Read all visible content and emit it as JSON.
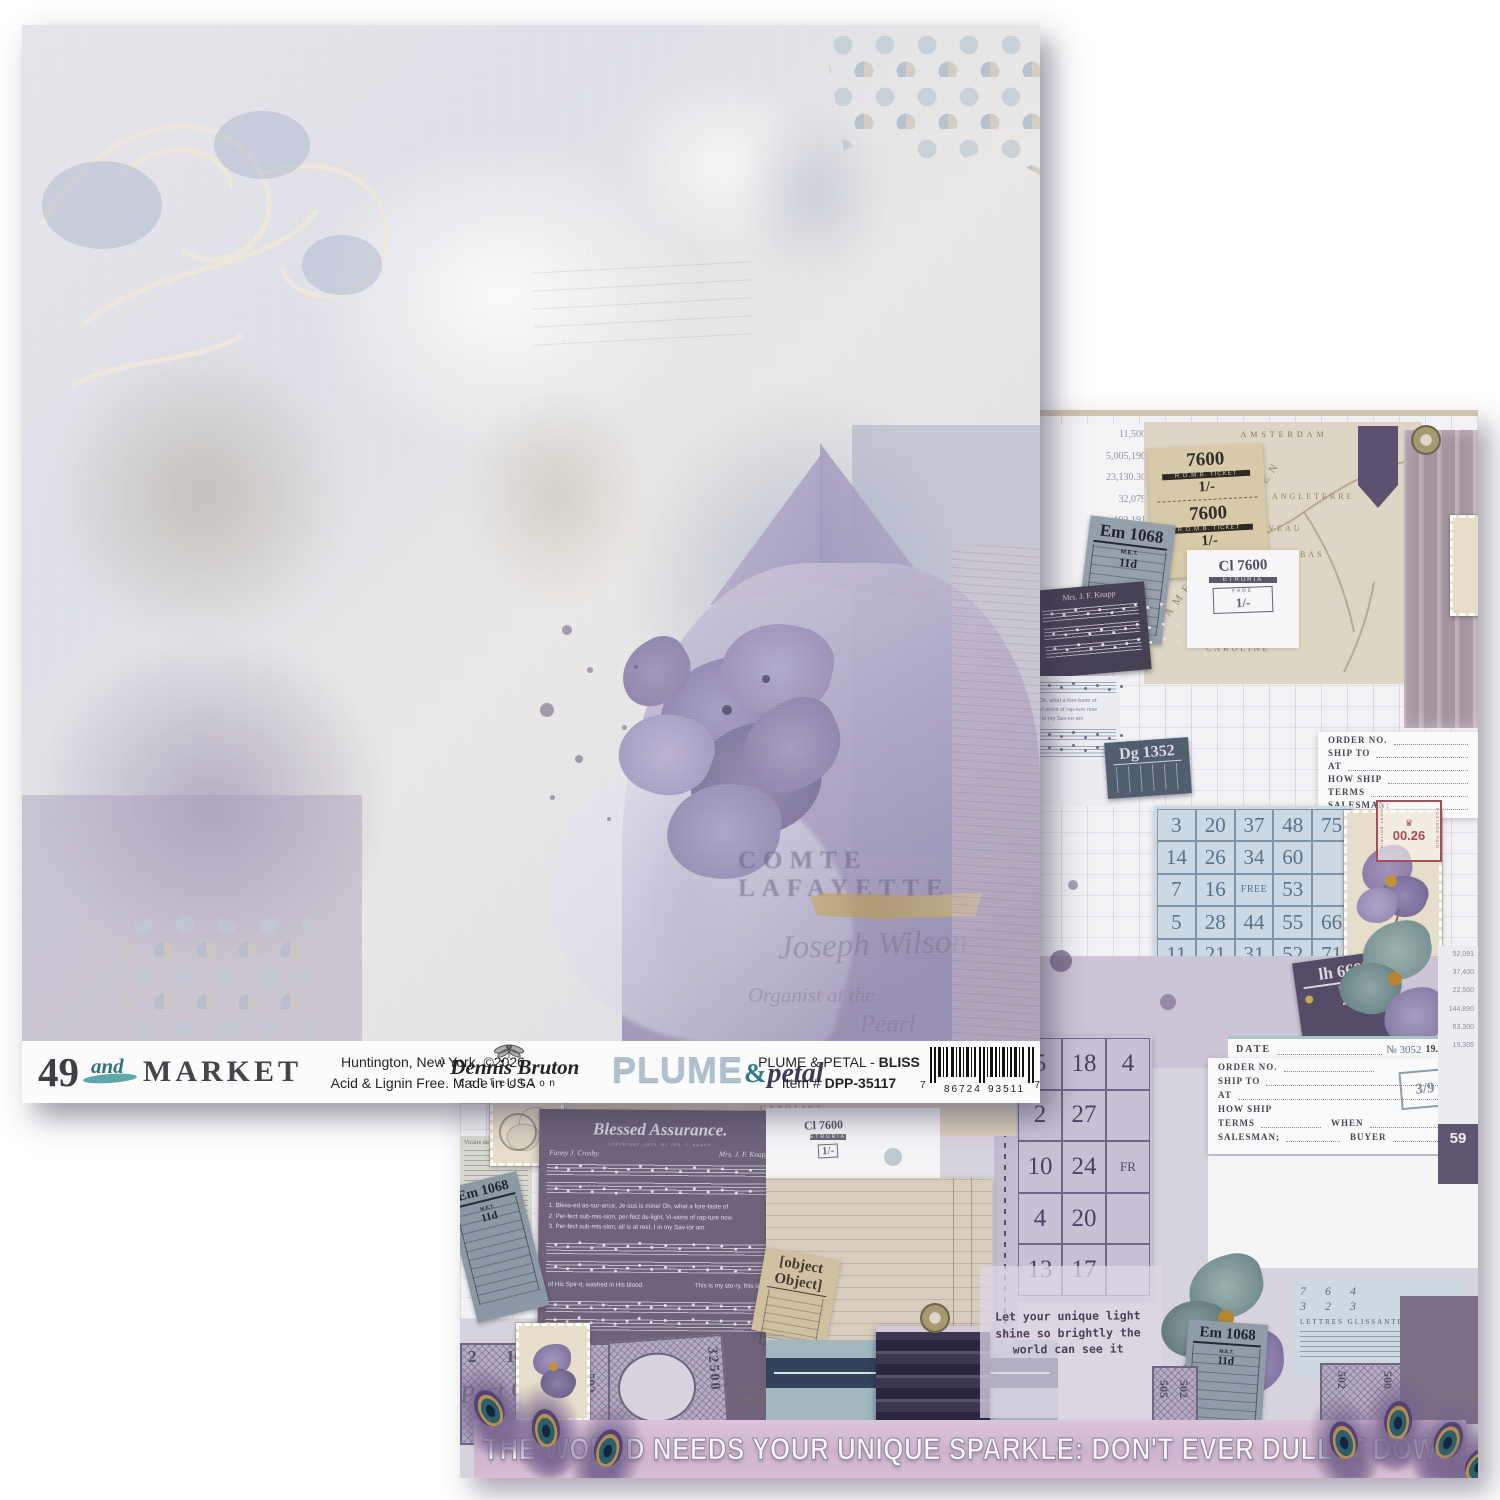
{
  "branding": {
    "logo": {
      "num": "49",
      "and": "and",
      "market": "MARKET"
    },
    "collection": {
      "a": "A",
      "name": "Dennis Bruton",
      "word": "Collection"
    },
    "line": {
      "plume": "PLUME",
      "amp": "&",
      "petal": "petal"
    },
    "address1": "Huntington, New York. ©2026",
    "address2": "Acid & Lignin Free. Made in USA",
    "series": "PLUME & PETAL -",
    "name": "BLISS",
    "item_label": "Item #",
    "item": "DPP-35117",
    "barcode": {
      "left": "7",
      "group1": "86724",
      "group2": "93511",
      "right": "7"
    }
  },
  "front": {
    "ghost1": "COMTE LAFAYETTE",
    "ghost2": "Joseph Wilson",
    "ghost3": "Organist at the",
    "ghost4": "Pearl"
  },
  "back": {
    "map": {
      "arc": "AMERIQUE SEPTEN",
      "city": "AMSTERDAM",
      "l1": "ANGLETERRE",
      "l2": "NOUVEAU",
      "l3": "PAYS BAS",
      "l4": "VIRGINIE",
      "l5": "CAROLINE",
      "band_e": "E R",
      "band_caroline": "CAROLINE"
    },
    "ledgerA": [
      "11,500",
      "5,005,190",
      "23,130.30",
      "32,079",
      "192,191",
      "303,750",
      "6,236",
      "£25,000",
      "31,419",
      "29,006"
    ],
    "ledgerR": [
      "52,091",
      "37,400",
      "22,500",
      "144,890",
      "63,300",
      "19,305"
    ],
    "t7600": {
      "num": "7600",
      "sub": "R.O.M.B. TICKET",
      "fare": "1/-"
    },
    "em1068": {
      "code": "Em 1068",
      "met": "M.E.T.",
      "fare": "11d"
    },
    "dg1352": {
      "code": "Dg 1352"
    },
    "tan1352": {
      "code": "1352"
    },
    "lh6687": {
      "code": "lh 6687",
      "met": "M.E.T.",
      "fare": "2d"
    },
    "cl7600": {
      "code": "Cl 7600",
      "sub": "ETRURIA",
      "fare_label": "FARE",
      "fare": "1/-"
    },
    "meter": {
      "country": "GREAT BRITAIN",
      "value": "00.26",
      "paid": "POSTAGE PAID"
    },
    "order": {
      "f0": "ORDER NO.",
      "f1": "SHIP TO",
      "f2": "AT",
      "f3": "HOW SHIP",
      "f4": "TERMS",
      "f5": "SALESMAN;",
      "when": "WHEN",
      "buyer": "BUYER",
      "date": "DATE",
      "no": "№ 3052",
      "yr": "19.",
      "stamp": "3/9"
    },
    "bingo1": {
      "r0": [
        "3",
        "20",
        "37",
        "48",
        "75"
      ],
      "r1": [
        "14",
        "26",
        "34",
        "60",
        ""
      ],
      "r2": [
        "7",
        "16",
        "FREE",
        "53",
        ""
      ],
      "r3": [
        "5",
        "28",
        "44",
        "55",
        "66"
      ],
      "r4": [
        "11",
        "21",
        "31",
        "52",
        "71"
      ]
    },
    "bingo2": {
      "r0": [
        "5",
        "18",
        "4"
      ],
      "r1": [
        "2",
        "27",
        ""
      ],
      "r2": [
        "10",
        "24",
        "FR"
      ],
      "r3": [
        "4",
        "20",
        ""
      ],
      "r4": [
        "13",
        "17",
        ""
      ]
    },
    "blessed": {
      "title": "Blessed Assurance.",
      "copyright": "COPYRIGHT, 1873, BY JOS. F. KNAPP.",
      "credit_l": "Fanny J. Crosby.",
      "credit_r": "Mrs. J. F. Knapp.",
      "v1": "1. Bless-ed as-sur-ance, Je-sus is mine!  Oh, what a fore-taste of",
      "v2": "2. Per-fect sub-mis-sion, per-fect de-light,  Vi-sions of rap-ture now",
      "v3": "3. Per-fect sub-mis-sion, all is at rest,  I in my Sav-ior am",
      "c1": "of His Spir-it, washed in His blood.",
      "c2": "This is my sto-ry, this is my"
    },
    "knapp": "Mrs. J. F. Knapp",
    "hymn_frag": {
      "l1": "Oh, what a fore-taste of",
      "l2": "Vi-sions of rap-ture now",
      "l3": "I in my Sav-ior am"
    },
    "quote": {
      "l1": "Let your unique light",
      "l2": "shine so brightly the",
      "l3": "world can see it"
    },
    "postcard": "Post Card",
    "lettres": {
      "heading": "LETTRES GLISSANTES",
      "digits1": "7 6 4",
      "digits2": "3 2 3"
    },
    "news_frag": "Vicaire du roi de",
    "banknote": {
      "value": "32500",
      "n2": "2",
      "n10": "10",
      "s505": "505",
      "s502": "502",
      "s500": "500"
    },
    "thanks": {
      "l1": "Thank you",
      "l2": "Call again"
    },
    "page_no": "59",
    "pad_footer": "Chicago or New York City",
    "banner": "THE WORLD NEEDS YOUR UNIQUE SPARKLE: DON'T EVER DULL IT DOWN"
  }
}
